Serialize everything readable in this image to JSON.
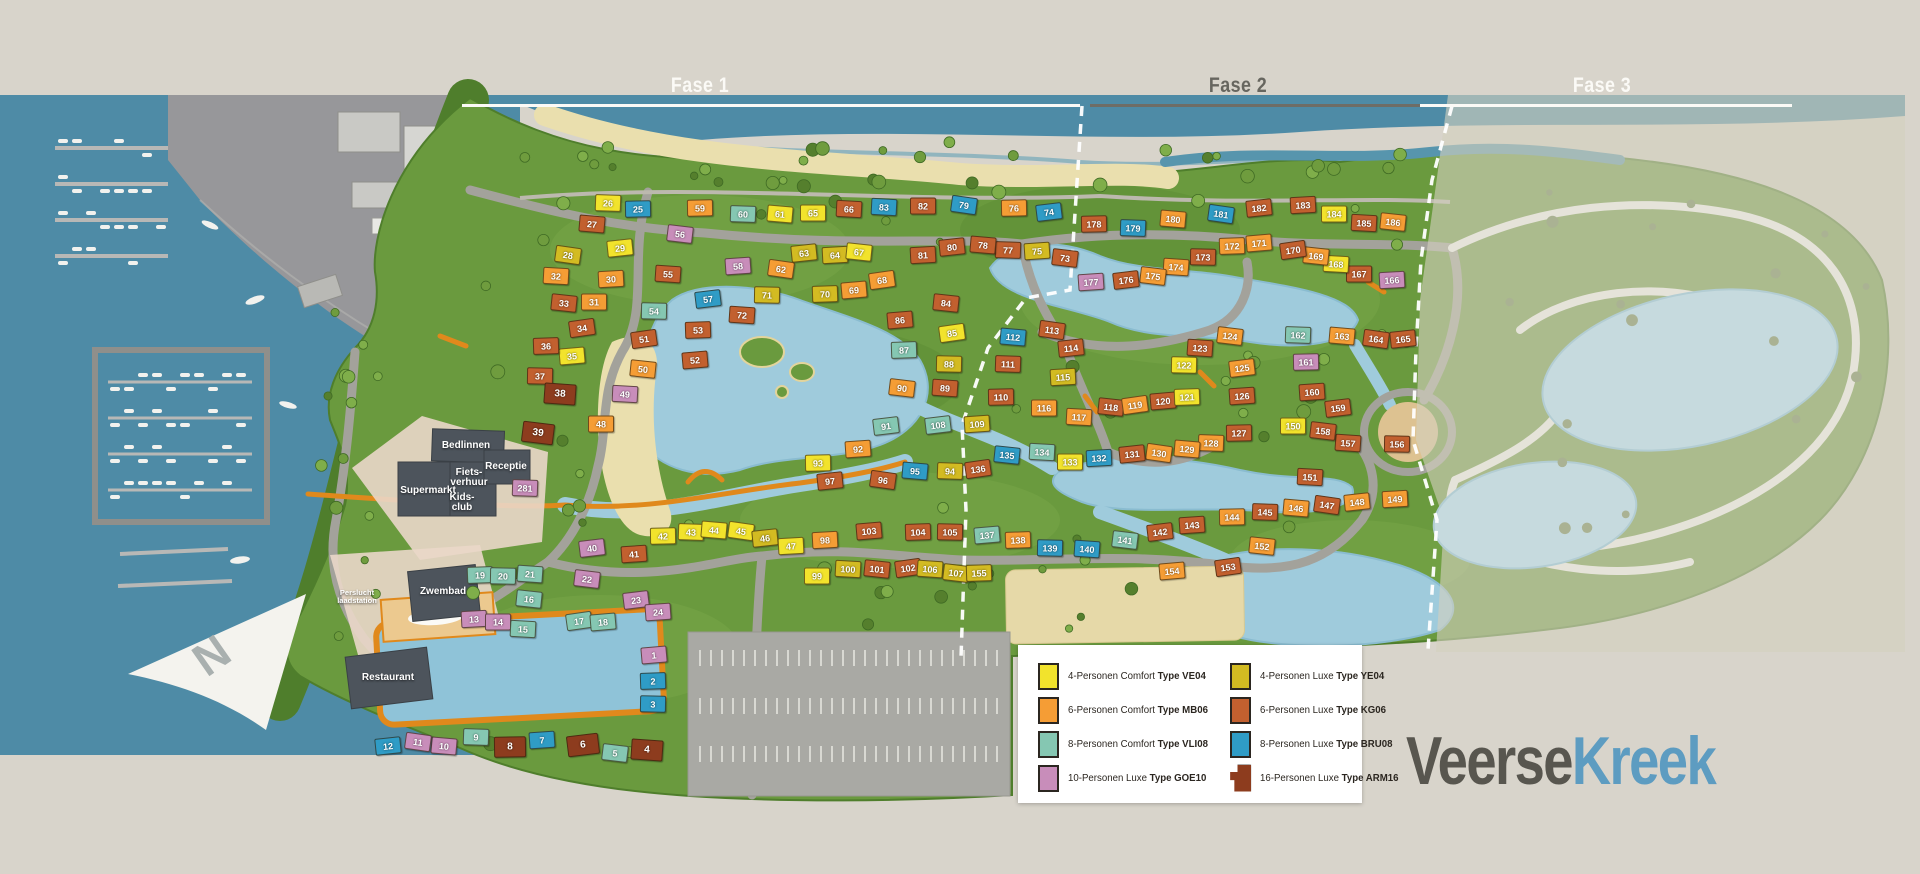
{
  "header": {
    "phases": [
      {
        "label": "Fase 1"
      },
      {
        "label": "Fase 2"
      },
      {
        "label": "Fase 3"
      }
    ]
  },
  "logo": {
    "part1": "Veerse",
    "part2": "Kreek"
  },
  "north_arrow_label": "N",
  "colors": {
    "VE04": "#f2e32c",
    "MB06": "#f59d35",
    "VLI08": "#85c7b2",
    "GOE10": "#c88dba",
    "YE04": "#d3bb22",
    "KG06": "#c2602f",
    "BRU08": "#2f9cc6",
    "ARM16": "#8d3c1e"
  },
  "legend": {
    "items": [
      {
        "label": "4-Personen Comfort ",
        "type": "Type VE04",
        "key": "VE04"
      },
      {
        "label": "6-Personen Comfort ",
        "type": "Type MB06",
        "key": "MB06"
      },
      {
        "label": "8-Personen Comfort ",
        "type": "Type VLI08",
        "key": "VLI08"
      },
      {
        "label": "10-Personen Luxe ",
        "type": "Type GOE10",
        "key": "GOE10"
      },
      {
        "label": "4-Personen Luxe ",
        "type": "Type YE04",
        "key": "YE04"
      },
      {
        "label": "6-Personen Luxe ",
        "type": "Type KG06",
        "key": "KG06"
      },
      {
        "label": "8-Personen Luxe ",
        "type": "Type BRU08",
        "key": "BRU08"
      },
      {
        "label": "16-Personen Luxe ",
        "type": "Type ARM16",
        "key": "ARM16"
      }
    ]
  },
  "facilities": [
    {
      "label": "Bedlinnen",
      "x": 466,
      "y": 446,
      "small": false
    },
    {
      "label": "Fiets-\nverhuur",
      "x": 469,
      "y": 478,
      "small": false
    },
    {
      "label": "Supermarkt",
      "x": 428,
      "y": 491,
      "small": false
    },
    {
      "label": "Kids-\nclub",
      "x": 462,
      "y": 503,
      "small": false
    },
    {
      "label": "Receptie",
      "x": 506,
      "y": 467,
      "small": false
    },
    {
      "label": "Zwembad",
      "x": 443,
      "y": 592,
      "small": false
    },
    {
      "label": "Restaurant",
      "x": 388,
      "y": 678,
      "small": false
    },
    {
      "label": "Perslucht\nlaadstation",
      "x": 357,
      "y": 597,
      "small": true
    }
  ],
  "lots": [
    [
      1,
      654,
      655,
      "GOE10"
    ],
    [
      2,
      653,
      681,
      "BRU08"
    ],
    [
      3,
      653,
      704,
      "BRU08"
    ],
    [
      4,
      647,
      750,
      "ARM16"
    ],
    [
      5,
      615,
      753,
      "VLI08"
    ],
    [
      6,
      583,
      745,
      "ARM16"
    ],
    [
      7,
      542,
      740,
      "BRU08"
    ],
    [
      8,
      510,
      747,
      "ARM16"
    ],
    [
      9,
      476,
      737,
      "VLI08"
    ],
    [
      10,
      444,
      746,
      "GOE10"
    ],
    [
      11,
      418,
      742,
      "GOE10"
    ],
    [
      12,
      388,
      746,
      "BRU08"
    ],
    [
      13,
      474,
      619,
      "GOE10"
    ],
    [
      14,
      498,
      622,
      "GOE10"
    ],
    [
      15,
      523,
      629,
      "VLI08"
    ],
    [
      16,
      529,
      599,
      "VLI08"
    ],
    [
      17,
      579,
      621,
      "VLI08"
    ],
    [
      18,
      603,
      622,
      "VLI08"
    ],
    [
      19,
      480,
      575,
      "VLI08"
    ],
    [
      20,
      503,
      576,
      "VLI08"
    ],
    [
      21,
      530,
      574,
      "VLI08"
    ],
    [
      22,
      587,
      579,
      "GOE10"
    ],
    [
      23,
      636,
      600,
      "GOE10"
    ],
    [
      24,
      658,
      612,
      "GOE10"
    ],
    [
      25,
      638,
      209,
      "BRU08"
    ],
    [
      26,
      608,
      203,
      "VE04"
    ],
    [
      27,
      592,
      224,
      "KG06"
    ],
    [
      28,
      568,
      255,
      "YE04"
    ],
    [
      29,
      620,
      248,
      "VE04"
    ],
    [
      30,
      611,
      279,
      "MB06"
    ],
    [
      31,
      594,
      302,
      "MB06"
    ],
    [
      32,
      556,
      276,
      "MB06"
    ],
    [
      33,
      564,
      303,
      "KG06"
    ],
    [
      34,
      582,
      328,
      "KG06"
    ],
    [
      35,
      572,
      356,
      "VE04"
    ],
    [
      36,
      546,
      346,
      "KG06"
    ],
    [
      37,
      540,
      376,
      "KG06"
    ],
    [
      38,
      560,
      394,
      "ARM16"
    ],
    [
      39,
      538,
      433,
      "ARM16"
    ],
    [
      40,
      592,
      548,
      "GOE10"
    ],
    [
      41,
      634,
      554,
      "KG06"
    ],
    [
      42,
      663,
      536,
      "VE04"
    ],
    [
      43,
      691,
      532,
      "VE04"
    ],
    [
      44,
      714,
      530,
      "VE04"
    ],
    [
      45,
      741,
      531,
      "VE04"
    ],
    [
      46,
      765,
      538,
      "YE04"
    ],
    [
      47,
      791,
      546,
      "VE04"
    ],
    [
      48,
      601,
      424,
      "MB06"
    ],
    [
      49,
      625,
      394,
      "GOE10"
    ],
    [
      50,
      643,
      369,
      "MB06"
    ],
    [
      51,
      644,
      339,
      "KG06"
    ],
    [
      52,
      695,
      360,
      "KG06"
    ],
    [
      53,
      698,
      330,
      "KG06"
    ],
    [
      54,
      654,
      311,
      "VLI08"
    ],
    [
      55,
      668,
      274,
      "KG06"
    ],
    [
      56,
      680,
      234,
      "GOE10"
    ],
    [
      57,
      708,
      299,
      "BRU08"
    ],
    [
      58,
      738,
      266,
      "GOE10"
    ],
    [
      59,
      700,
      208,
      "MB06"
    ],
    [
      60,
      743,
      214,
      "VLI08"
    ],
    [
      61,
      780,
      214,
      "VE04"
    ],
    [
      62,
      781,
      269,
      "MB06"
    ],
    [
      63,
      804,
      253,
      "YE04"
    ],
    [
      64,
      835,
      255,
      "YE04"
    ],
    [
      65,
      813,
      213,
      "VE04"
    ],
    [
      66,
      849,
      209,
      "KG06"
    ],
    [
      67,
      859,
      252,
      "VE04"
    ],
    [
      68,
      882,
      280,
      "MB06"
    ],
    [
      69,
      854,
      290,
      "MB06"
    ],
    [
      70,
      825,
      294,
      "YE04"
    ],
    [
      71,
      767,
      295,
      "YE04"
    ],
    [
      72,
      742,
      315,
      "KG06"
    ],
    [
      73,
      1065,
      258,
      "KG06"
    ],
    [
      74,
      1049,
      212,
      "BRU08"
    ],
    [
      75,
      1037,
      251,
      "YE04"
    ],
    [
      76,
      1014,
      208,
      "MB06"
    ],
    [
      77,
      1008,
      250,
      "KG06"
    ],
    [
      78,
      983,
      245,
      "KG06"
    ],
    [
      79,
      964,
      205,
      "BRU08"
    ],
    [
      80,
      952,
      247,
      "KG06"
    ],
    [
      81,
      923,
      255,
      "KG06"
    ],
    [
      82,
      923,
      206,
      "KG06"
    ],
    [
      83,
      884,
      207,
      "BRU08"
    ],
    [
      84,
      946,
      303,
      "KG06"
    ],
    [
      85,
      952,
      333,
      "VE04"
    ],
    [
      86,
      900,
      320,
      "KG06"
    ],
    [
      87,
      904,
      350,
      "VLI08"
    ],
    [
      88,
      949,
      364,
      "YE04"
    ],
    [
      89,
      945,
      388,
      "KG06"
    ],
    [
      90,
      902,
      388,
      "MB06"
    ],
    [
      91,
      886,
      426,
      "VLI08"
    ],
    [
      92,
      858,
      449,
      "MB06"
    ],
    [
      93,
      818,
      463,
      "VE04"
    ],
    [
      94,
      950,
      471,
      "YE04"
    ],
    [
      95,
      915,
      471,
      "BRU08"
    ],
    [
      96,
      883,
      480,
      "KG06"
    ],
    [
      97,
      830,
      481,
      "KG06"
    ],
    [
      98,
      825,
      540,
      "MB06"
    ],
    [
      99,
      817,
      576,
      "VE04"
    ],
    [
      100,
      848,
      569,
      "YE04"
    ],
    [
      101,
      877,
      569,
      "KG06"
    ],
    [
      102,
      908,
      568,
      "KG06"
    ],
    [
      103,
      869,
      531,
      "KG06"
    ],
    [
      104,
      918,
      532,
      "KG06"
    ],
    [
      105,
      950,
      532,
      "KG06"
    ],
    [
      106,
      930,
      569,
      "YE04"
    ],
    [
      107,
      956,
      573,
      "YE04"
    ],
    [
      108,
      938,
      425,
      "VLI08"
    ],
    [
      109,
      977,
      424,
      "YE04"
    ],
    [
      110,
      1001,
      397,
      "KG06"
    ],
    [
      111,
      1008,
      364,
      "KG06"
    ],
    [
      112,
      1013,
      337,
      "BRU08"
    ],
    [
      113,
      1052,
      330,
      "KG06"
    ],
    [
      114,
      1071,
      348,
      "KG06"
    ],
    [
      115,
      1063,
      377,
      "YE04"
    ],
    [
      116,
      1044,
      408,
      "MB06"
    ],
    [
      117,
      1079,
      417,
      "MB06"
    ],
    [
      118,
      1111,
      407,
      "KG06"
    ],
    [
      119,
      1135,
      405,
      "MB06"
    ],
    [
      120,
      1163,
      401,
      "KG06"
    ],
    [
      121,
      1187,
      397,
      "VE04"
    ],
    [
      122,
      1184,
      365,
      "VE04"
    ],
    [
      123,
      1200,
      348,
      "KG06"
    ],
    [
      124,
      1230,
      336,
      "MB06"
    ],
    [
      125,
      1242,
      368,
      "MB06"
    ],
    [
      126,
      1242,
      396,
      "KG06"
    ],
    [
      127,
      1239,
      433,
      "KG06"
    ],
    [
      128,
      1211,
      443,
      "MB06"
    ],
    [
      129,
      1187,
      449,
      "MB06"
    ],
    [
      130,
      1159,
      453,
      "MB06"
    ],
    [
      131,
      1132,
      454,
      "KG06"
    ],
    [
      132,
      1099,
      458,
      "BRU08"
    ],
    [
      133,
      1070,
      462,
      "VE04"
    ],
    [
      134,
      1042,
      452,
      "VLI08"
    ],
    [
      135,
      1007,
      455,
      "BRU08"
    ],
    [
      136,
      978,
      469,
      "KG06"
    ],
    [
      137,
      987,
      535,
      "VLI08"
    ],
    [
      138,
      1018,
      540,
      "MB06"
    ],
    [
      139,
      1050,
      548,
      "BRU08"
    ],
    [
      140,
      1087,
      549,
      "BRU08"
    ],
    [
      141,
      1125,
      540,
      "VLI08"
    ],
    [
      142,
      1160,
      532,
      "KG06"
    ],
    [
      143,
      1192,
      525,
      "KG06"
    ],
    [
      144,
      1232,
      517,
      "MB06"
    ],
    [
      145,
      1265,
      512,
      "KG06"
    ],
    [
      146,
      1296,
      508,
      "MB06"
    ],
    [
      147,
      1327,
      505,
      "KG06"
    ],
    [
      148,
      1357,
      502,
      "MB06"
    ],
    [
      149,
      1395,
      499,
      "MB06"
    ],
    [
      150,
      1293,
      426,
      "VE04"
    ],
    [
      151,
      1310,
      477,
      "KG06"
    ],
    [
      152,
      1262,
      546,
      "MB06"
    ],
    [
      153,
      1228,
      567,
      "KG06"
    ],
    [
      154,
      1172,
      571,
      "MB06"
    ],
    [
      155,
      979,
      573,
      "YE04"
    ],
    [
      156,
      1397,
      444,
      "KG06"
    ],
    [
      157,
      1348,
      443,
      "KG06"
    ],
    [
      158,
      1323,
      431,
      "KG06"
    ],
    [
      159,
      1338,
      408,
      "KG06"
    ],
    [
      160,
      1312,
      392,
      "KG06"
    ],
    [
      161,
      1306,
      362,
      "GOE10"
    ],
    [
      162,
      1298,
      335,
      "VLI08"
    ],
    [
      163,
      1342,
      336,
      "MB06"
    ],
    [
      164,
      1376,
      339,
      "KG06"
    ],
    [
      165,
      1403,
      339,
      "KG06"
    ],
    [
      166,
      1392,
      280,
      "GOE10"
    ],
    [
      167,
      1359,
      274,
      "KG06"
    ],
    [
      168,
      1336,
      264,
      "VE04"
    ],
    [
      169,
      1316,
      256,
      "MB06"
    ],
    [
      170,
      1293,
      250,
      "KG06"
    ],
    [
      171,
      1259,
      243,
      "MB06"
    ],
    [
      172,
      1232,
      246,
      "MB06"
    ],
    [
      173,
      1203,
      257,
      "KG06"
    ],
    [
      174,
      1176,
      267,
      "MB06"
    ],
    [
      175,
      1153,
      276,
      "MB06"
    ],
    [
      176,
      1126,
      280,
      "KG06"
    ],
    [
      177,
      1091,
      282,
      "GOE10"
    ],
    [
      178,
      1094,
      224,
      "KG06"
    ],
    [
      179,
      1133,
      228,
      "BRU08"
    ],
    [
      180,
      1173,
      219,
      "MB06"
    ],
    [
      181,
      1221,
      214,
      "BRU08"
    ],
    [
      182,
      1259,
      208,
      "KG06"
    ],
    [
      183,
      1303,
      205,
      "KG06"
    ],
    [
      184,
      1334,
      214,
      "VE04"
    ],
    [
      185,
      1364,
      223,
      "KG06"
    ],
    [
      186,
      1393,
      222,
      "MB06"
    ],
    [
      281,
      525,
      488,
      "GOE10"
    ]
  ]
}
